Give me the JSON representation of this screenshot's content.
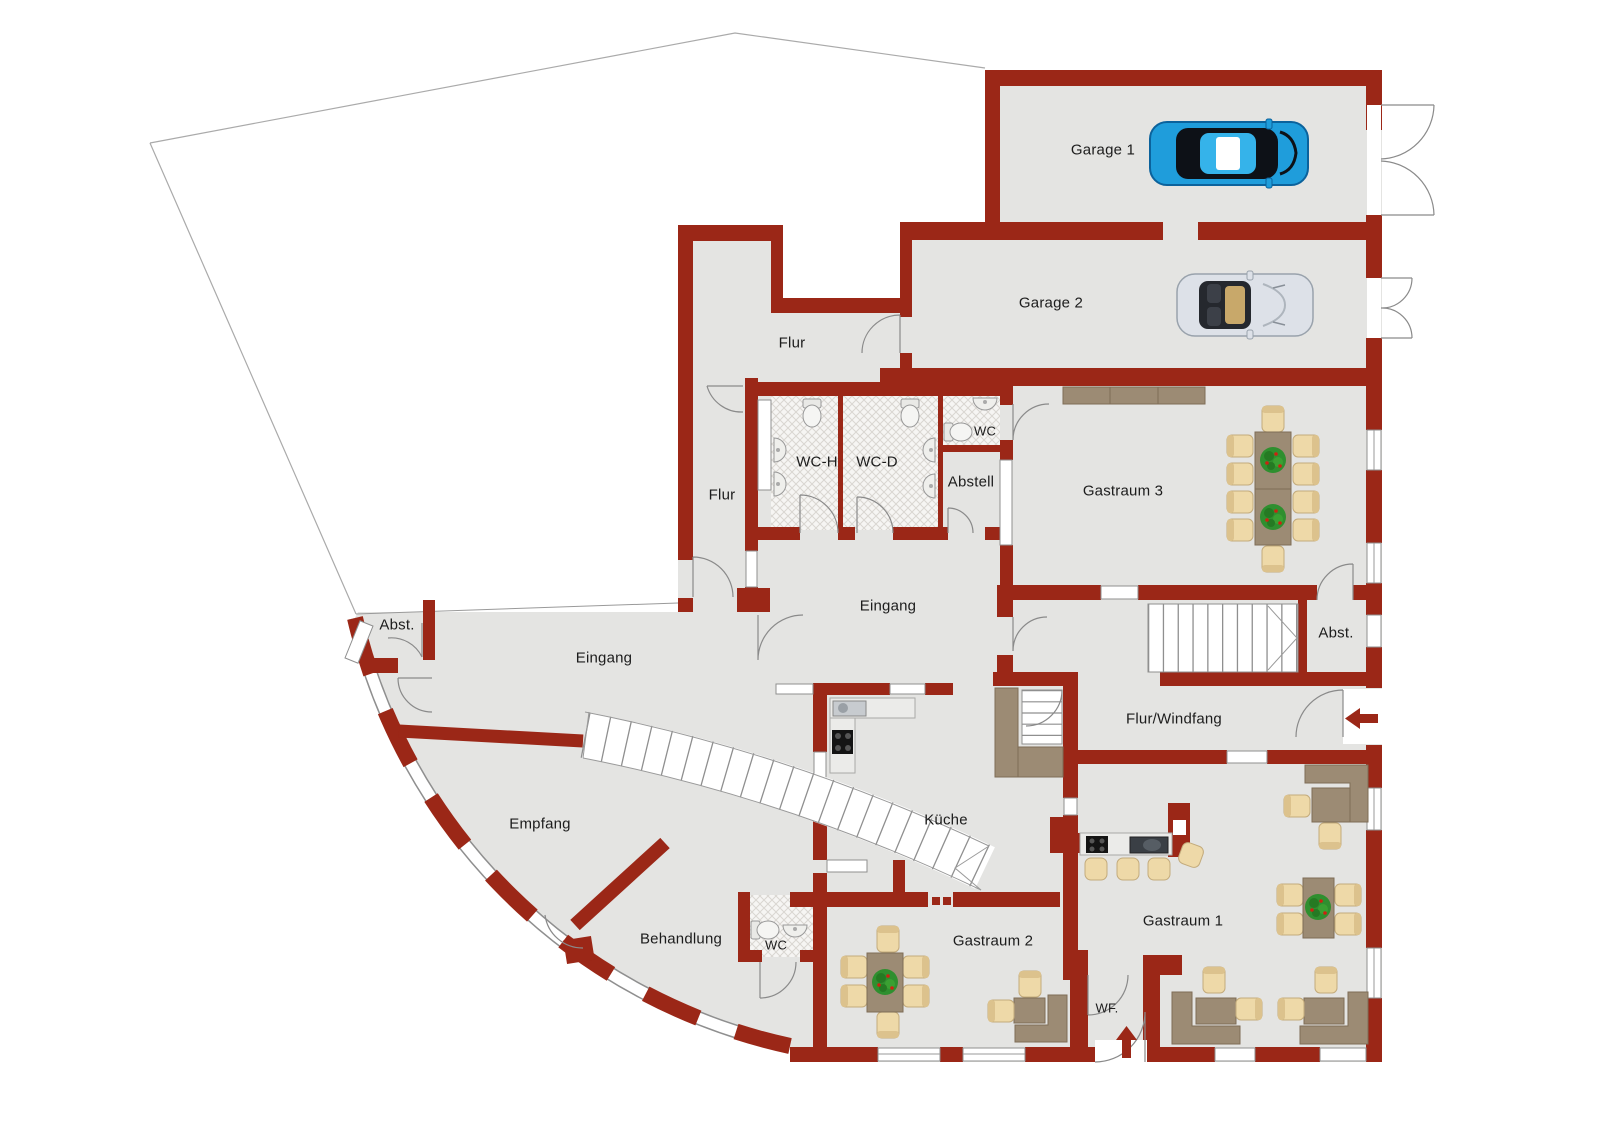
{
  "rooms": {
    "garage1": "Garage 1",
    "garage2": "Garage 2",
    "flur_top": "Flur",
    "wc_h": "WC-H",
    "wc_d": "WC-D",
    "wc_small": "WC",
    "abstell": "Abstell",
    "gastraum3": "Gastraum 3",
    "flur_left": "Flur",
    "eingang_center": "Eingang",
    "abst_left": "Abst.",
    "eingang_left": "Eingang",
    "abst_right": "Abst.",
    "flur_windfang": "Flur/Windfang",
    "kueche": "Küche",
    "empfang": "Empfang",
    "behandlung": "Behandlung",
    "wc_behandlung": "WC",
    "gastraum2": "Gastraum 2",
    "gastraum1": "Gastraum 1",
    "windfang_short": "WF."
  },
  "colors": {
    "wall": "#9b2717",
    "floor": "#e4e4e2",
    "furniture": "#9c8b74",
    "chair": "#eed9a8",
    "plant_green": "#2f8f2f",
    "car_blue": "#1f9ddb",
    "car_silver": "#dde1e8",
    "window_line": "#8f8f8f",
    "entrance_arrow": "#9b2717"
  }
}
